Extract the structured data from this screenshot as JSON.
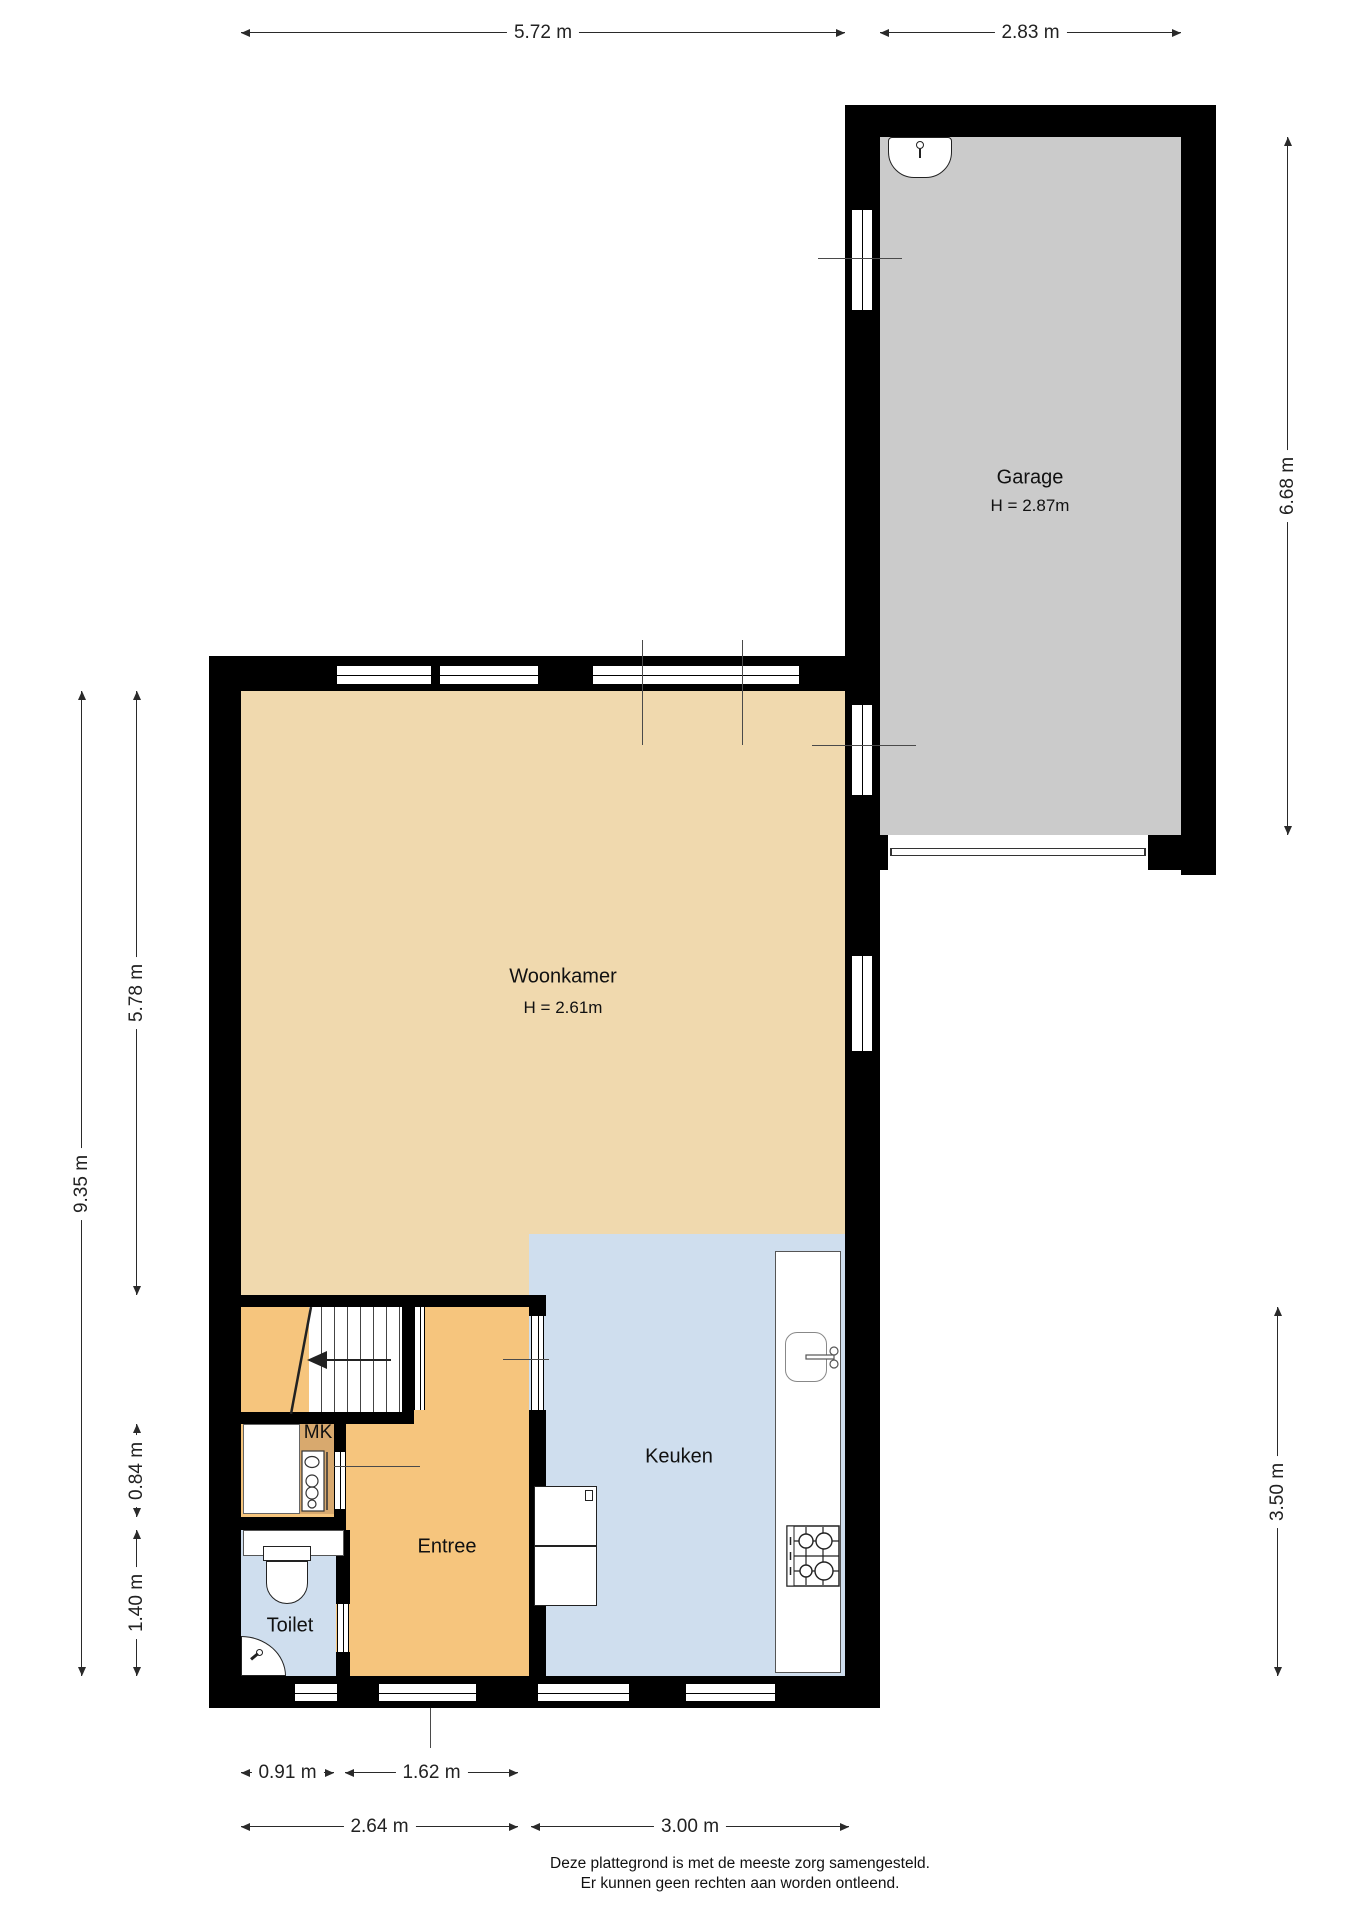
{
  "rooms": {
    "garage": {
      "label": "Garage",
      "ceiling": "H = 2.87m"
    },
    "woonkamer": {
      "label": "Woonkamer",
      "ceiling": "H = 2.61m"
    },
    "keuken": {
      "label": "Keuken"
    },
    "entree": {
      "label": "Entree"
    },
    "toilet": {
      "label": "Toilet"
    },
    "meterkast": {
      "label": "MK"
    }
  },
  "dimensions": {
    "top_house": "5.72 m",
    "top_garage": "2.83 m",
    "right_garage": "6.68 m",
    "right_keuken": "3.50 m",
    "left_house": "9.35 m",
    "left_woonkamer": "5.78 m",
    "left_meterkast": "0.84 m",
    "left_toilet": "1.40 m",
    "bottom_toilet": "0.91 m",
    "bottom_entree": "1.62 m",
    "bottom_house_left": "2.64 m",
    "bottom_house_right": "3.00 m"
  },
  "footer": {
    "line1": "Deze plattegrond is met de meeste zorg samengesteld.",
    "line2": "Er kunnen geen rechten aan worden ontleend."
  },
  "colors": {
    "wall": "#000000",
    "woonkamer": "#F0D9AE",
    "entree_stairs": "#F6C57D",
    "keuken_toilet": "#CFDEEE",
    "garage": "#CBCBCB",
    "meterkast": "#D8A96E"
  }
}
